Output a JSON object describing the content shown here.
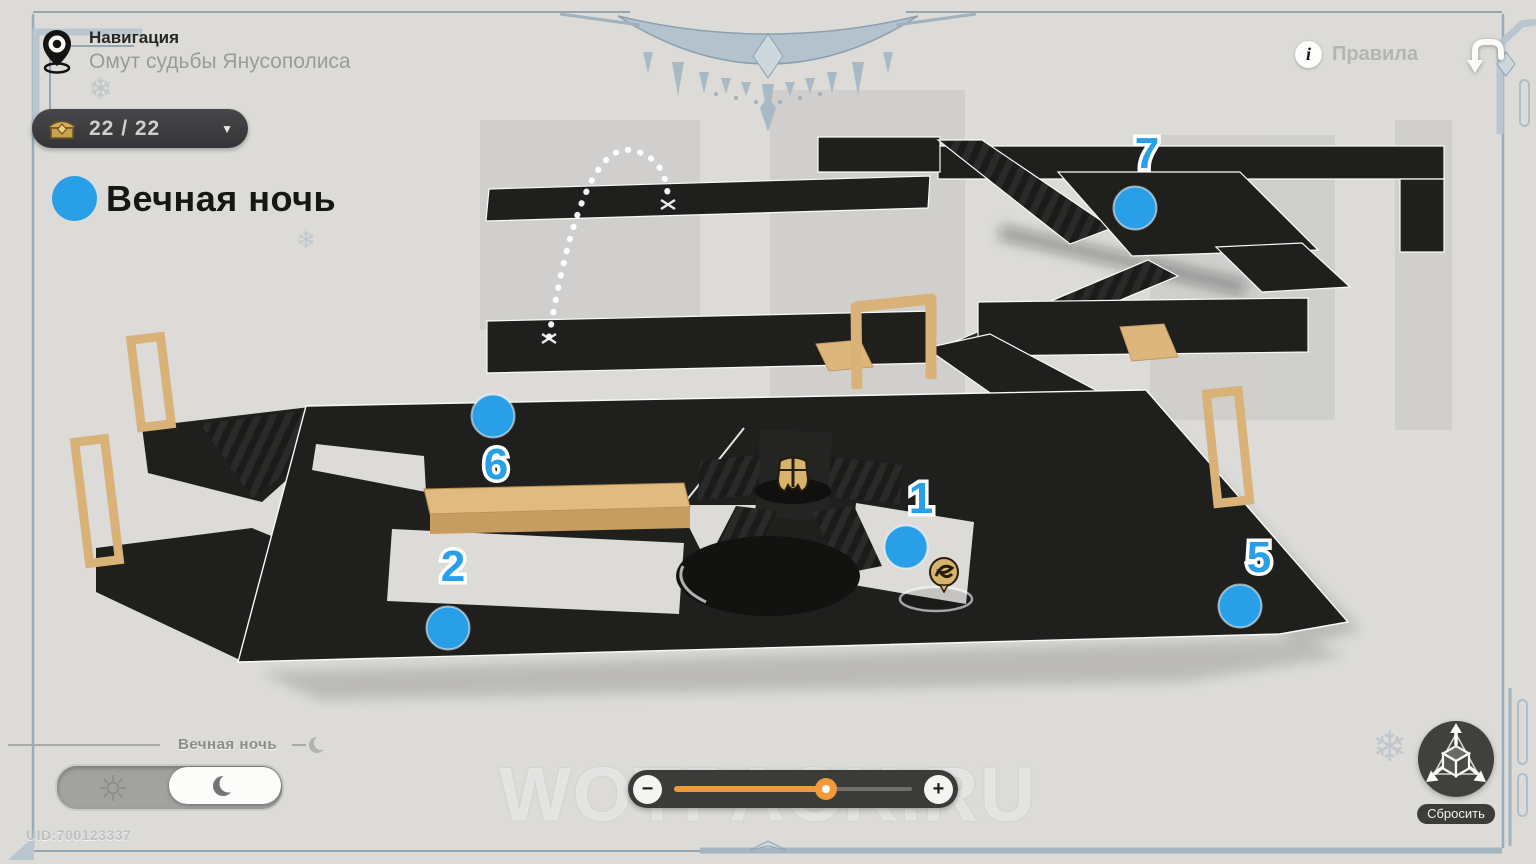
{
  "header": {
    "nav_label": "Навигация",
    "location_title": "Омут судьбы Янусополиса",
    "chest_count": "22 / 22",
    "chevron_glyph": "▼",
    "rules_label": "Правила",
    "info_glyph": "i"
  },
  "legend": {
    "label": "Вечная ночь"
  },
  "map": {
    "marker_color": "#299fe8",
    "markers": [
      {
        "num": "1",
        "cx": 906,
        "cy": 547,
        "lx": 921,
        "ly": 513
      },
      {
        "num": "2",
        "cx": 448,
        "cy": 628,
        "lx": 453,
        "ly": 581
      },
      {
        "num": "5",
        "cx": 1240,
        "cy": 606,
        "lx": 1259,
        "ly": 572
      },
      {
        "num": "6",
        "cx": 493,
        "cy": 416,
        "lx": 496,
        "ly": 479
      },
      {
        "num": "7",
        "cx": 1135,
        "cy": 208,
        "lx": 1147,
        "ly": 168
      }
    ],
    "icons": [
      {
        "id": "icon-helmet",
        "name": "elite-enemy-icon",
        "x": 793,
        "y": 477
      },
      {
        "id": "icon-swirl",
        "name": "small-enemy-icon",
        "x": 944,
        "y": 572
      }
    ]
  },
  "footer": {
    "mode_label": "Вечная ночь",
    "zoom_percent": 64,
    "minus_label": "−",
    "plus_label": "+",
    "reset_label": "Сбросить",
    "uid": "UID:700123337"
  },
  "watermark": "WOTPACK.RU",
  "decor": {
    "snowflake": "❄"
  }
}
